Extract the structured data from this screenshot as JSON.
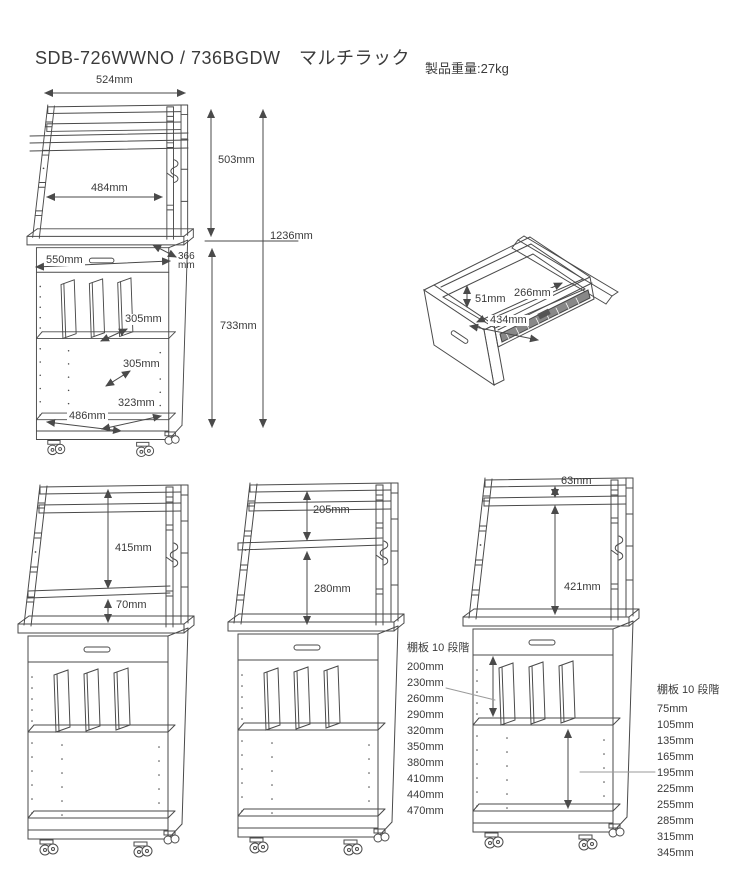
{
  "header": {
    "title": "SDB-726WWNO / 736BGDW　マルチラック",
    "weight": "製品重量:27kg"
  },
  "front_view": {
    "top_width": "524mm",
    "upper_height": "503mm",
    "inner_width": "484mm",
    "total_height": "1236mm",
    "counter_width": "550mm",
    "counter_depth_value": "366",
    "counter_depth_unit": "mm",
    "lower_height": "733mm",
    "divider_shelf_depth": "305mm",
    "middle_shelf_depth": "305mm",
    "bottom_shelf_depth": "323mm",
    "bottom_inner_width": "486mm"
  },
  "drawer_view": {
    "inner_height": "51mm",
    "inner_depth": "266mm",
    "inner_width": "434mm"
  },
  "variant_views": {
    "left": {
      "upper_space": "415mm",
      "lower_space": "70mm"
    },
    "middle": {
      "upper_space": "205mm",
      "lower_space": "280mm"
    },
    "right": {
      "top_space": "63mm",
      "main_space": "421mm"
    }
  },
  "shelf_lists": {
    "upper_compartment": {
      "title": "棚板 10 段階",
      "items": [
        "200mm",
        "230mm",
        "260mm",
        "290mm",
        "320mm",
        "350mm",
        "380mm",
        "410mm",
        "440mm",
        "470mm"
      ]
    },
    "lower_compartment": {
      "title": "棚板 10 段階",
      "items": [
        "75mm",
        "105mm",
        "135mm",
        "165mm",
        "195mm",
        "225mm",
        "255mm",
        "285mm",
        "315mm",
        "345mm"
      ]
    }
  },
  "colors": {
    "line": "#4a4a4a",
    "text": "#3a3a3a",
    "background": "#ffffff"
  }
}
